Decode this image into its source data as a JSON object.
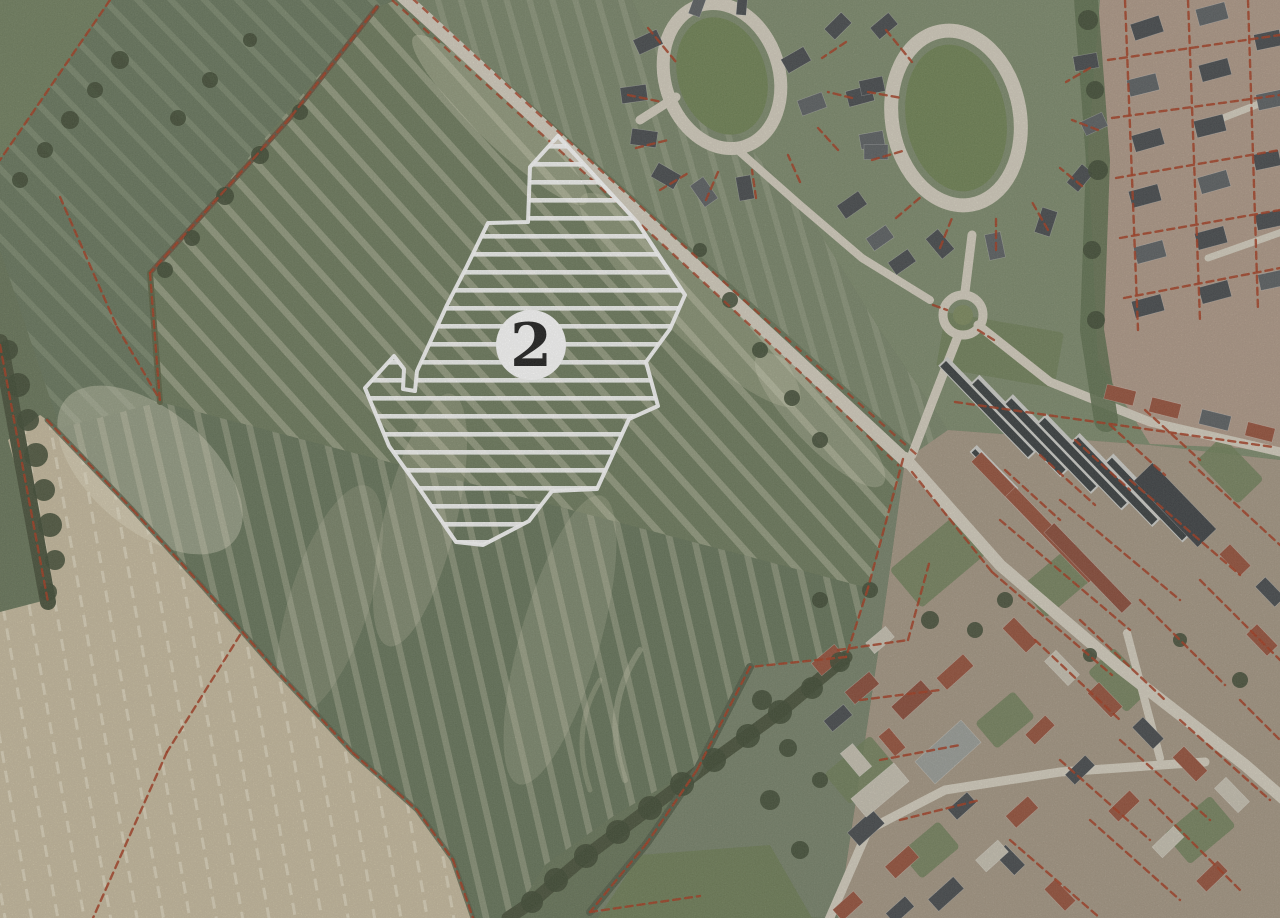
{
  "canvas": {
    "width": 1280,
    "height": 918
  },
  "map": {
    "type": "aerial-photograph-with-cadastral-overlay",
    "marker": {
      "label": "2",
      "bg": "#ffffff",
      "fg": "#1c1c1c"
    },
    "site": {
      "points": "558,136 637,222 685,295 670,329 646,362 658,406 629,419 597,489 552,491 529,521 483,545 456,542 421,491 389,446 365,388 394,356 404,369 403,389 415,391 417,371 447,305 466,268 488,223 528,222 530,167",
      "hatch_color": "#ffffff",
      "outline_color": "#ffffff"
    },
    "palette": {
      "cadastral": "#a63a1e",
      "road": "#d6d0c0",
      "hedge": "#48513a",
      "tree": "#3f4a33",
      "oval_green": "#6f8253",
      "garden_green": "#6e7f58",
      "roofs": {
        "dark": "#45494c",
        "mid": "#5b5f62",
        "red": "#96503a",
        "red2": "#8a4a38",
        "pale": "#c9c3b3",
        "dark2": "#3c4043",
        "gray2": "#9b9e99"
      }
    },
    "cadastral_segments": [
      [
        110,
        0,
        0,
        160
      ],
      [
        60,
        197,
        117,
        327
      ],
      [
        117,
        327,
        160,
        400
      ],
      [
        377,
        7,
        290,
        118
      ],
      [
        290,
        118,
        150,
        273
      ],
      [
        150,
        273,
        160,
        402
      ],
      [
        47,
        420,
        133,
        510
      ],
      [
        133,
        510,
        203,
        587
      ],
      [
        203,
        587,
        273,
        667
      ],
      [
        273,
        667,
        353,
        753
      ],
      [
        353,
        753,
        417,
        810
      ],
      [
        417,
        810,
        453,
        860
      ],
      [
        453,
        860,
        473,
        918
      ],
      [
        240,
        635,
        167,
        752
      ],
      [
        167,
        752,
        93,
        918
      ],
      [
        0,
        345,
        48,
        602
      ],
      [
        903,
        459,
        868,
        588
      ],
      [
        868,
        588,
        846,
        657
      ],
      [
        846,
        657,
        750,
        667
      ],
      [
        750,
        667,
        697,
        770
      ],
      [
        697,
        770,
        647,
        843
      ],
      [
        647,
        843,
        590,
        912
      ],
      [
        590,
        912,
        700,
        896
      ],
      [
        912,
        472,
        992,
        572
      ],
      [
        992,
        572,
        1112,
        675
      ],
      [
        955,
        402,
        1273,
        447
      ],
      [
        838,
        650,
        908,
        640
      ],
      [
        908,
        640,
        930,
        560
      ],
      [
        860,
        700,
        940,
        690
      ],
      [
        880,
        760,
        960,
        745
      ],
      [
        900,
        820,
        980,
        800
      ],
      [
        1005,
        470,
        1060,
        520
      ],
      [
        1040,
        455,
        1095,
        505
      ],
      [
        1075,
        440,
        1130,
        490
      ],
      [
        1110,
        425,
        1165,
        475
      ],
      [
        1145,
        410,
        1200,
        460
      ],
      [
        1000,
        520,
        1130,
        630
      ],
      [
        1060,
        500,
        1180,
        600
      ],
      [
        1130,
        480,
        1240,
        575
      ],
      [
        1190,
        462,
        1280,
        545
      ],
      [
        1035,
        640,
        1120,
        720
      ],
      [
        1080,
        620,
        1165,
        700
      ],
      [
        1140,
        600,
        1225,
        685
      ],
      [
        1200,
        580,
        1280,
        660
      ],
      [
        1060,
        760,
        1150,
        840
      ],
      [
        1120,
        740,
        1210,
        820
      ],
      [
        1180,
        720,
        1270,
        800
      ],
      [
        1240,
        700,
        1280,
        740
      ],
      [
        1010,
        840,
        1100,
        918
      ],
      [
        1090,
        820,
        1180,
        900
      ],
      [
        1150,
        800,
        1240,
        890
      ],
      [
        1125,
        0,
        1138,
        330
      ],
      [
        1188,
        0,
        1200,
        320
      ],
      [
        1248,
        0,
        1258,
        310
      ],
      [
        1108,
        60,
        1280,
        35
      ],
      [
        1112,
        118,
        1280,
        95
      ],
      [
        1116,
        178,
        1280,
        150
      ],
      [
        1120,
        238,
        1280,
        210
      ],
      [
        1124,
        298,
        1280,
        268
      ],
      [
        648,
        28,
        676,
        62
      ],
      [
        628,
        95,
        662,
        102
      ],
      [
        636,
        148,
        668,
        140
      ],
      [
        660,
        190,
        690,
        172
      ],
      [
        706,
        200,
        718,
        172
      ],
      [
        756,
        198,
        752,
        170
      ],
      [
        800,
        182,
        788,
        155
      ],
      [
        838,
        150,
        818,
        128
      ],
      [
        852,
        98,
        828,
        92
      ],
      [
        846,
        42,
        822,
        58
      ],
      [
        886,
        30,
        912,
        62
      ],
      [
        868,
        92,
        902,
        98
      ],
      [
        872,
        160,
        906,
        150
      ],
      [
        896,
        218,
        922,
        196
      ],
      [
        940,
        248,
        952,
        218
      ],
      [
        996,
        250,
        996,
        218
      ],
      [
        1048,
        230,
        1032,
        202
      ],
      [
        1082,
        186,
        1060,
        168
      ],
      [
        1098,
        130,
        1072,
        120
      ],
      [
        1090,
        68,
        1066,
        82
      ],
      [
        933,
        305,
        947,
        310
      ],
      [
        978,
        330,
        994,
        340
      ]
    ],
    "houses": [
      [
        648,
        42,
        26,
        16,
        -25,
        "dark"
      ],
      [
        634,
        94,
        26,
        16,
        -8,
        "dark"
      ],
      [
        644,
        138,
        26,
        16,
        8,
        "dark"
      ],
      [
        666,
        176,
        26,
        16,
        30,
        "dark"
      ],
      [
        704,
        192,
        26,
        16,
        55,
        "mid"
      ],
      [
        745,
        188,
        24,
        15,
        80,
        "dark"
      ],
      [
        698,
        4,
        24,
        12,
        -70,
        "mid"
      ],
      [
        742,
        4,
        22,
        10,
        -85,
        "dark"
      ],
      [
        796,
        60,
        26,
        16,
        -30,
        "dark"
      ],
      [
        812,
        104,
        26,
        16,
        -20,
        "mid"
      ],
      [
        838,
        26,
        24,
        15,
        -45,
        "dark"
      ],
      [
        860,
        96,
        26,
        16,
        -15,
        "dark"
      ],
      [
        872,
        140,
        24,
        15,
        -10,
        "mid"
      ],
      [
        884,
        26,
        24,
        15,
        -40,
        "dark"
      ],
      [
        872,
        86,
        24,
        15,
        -12,
        "dark"
      ],
      [
        876,
        152,
        24,
        15,
        0,
        "mid"
      ],
      [
        852,
        205,
        26,
        16,
        -35,
        "dark"
      ],
      [
        880,
        238,
        24,
        15,
        -35,
        "mid"
      ],
      [
        902,
        262,
        24,
        15,
        -35,
        "dark"
      ],
      [
        940,
        244,
        26,
        16,
        50,
        "dark"
      ],
      [
        995,
        246,
        26,
        16,
        78,
        "mid"
      ],
      [
        1046,
        222,
        26,
        16,
        -72,
        "dark"
      ],
      [
        1080,
        178,
        24,
        15,
        -50,
        "dark"
      ],
      [
        1094,
        124,
        24,
        15,
        -25,
        "mid"
      ],
      [
        1086,
        62,
        24,
        15,
        -10,
        "dark"
      ],
      [
        1147,
        28,
        30,
        17,
        -18,
        "dark"
      ],
      [
        1143,
        85,
        30,
        17,
        -14,
        "mid"
      ],
      [
        1148,
        140,
        30,
        17,
        -16,
        "dark"
      ],
      [
        1145,
        196,
        30,
        17,
        -15,
        "dark"
      ],
      [
        1150,
        252,
        30,
        17,
        -15,
        "mid"
      ],
      [
        1148,
        306,
        30,
        17,
        -15,
        "dark"
      ],
      [
        1212,
        14,
        30,
        17,
        -15,
        "mid"
      ],
      [
        1215,
        70,
        30,
        17,
        -15,
        "dark"
      ],
      [
        1210,
        126,
        30,
        17,
        -14,
        "dark"
      ],
      [
        1214,
        182,
        30,
        17,
        -16,
        "mid"
      ],
      [
        1211,
        238,
        30,
        17,
        -15,
        "dark"
      ],
      [
        1215,
        292,
        30,
        17,
        -15,
        "dark"
      ],
      [
        1268,
        40,
        26,
        16,
        -12,
        "dark"
      ],
      [
        1270,
        100,
        26,
        16,
        -12,
        "mid"
      ],
      [
        1267,
        160,
        26,
        16,
        -12,
        "dark"
      ],
      [
        1269,
        220,
        26,
        16,
        -12,
        "dark"
      ],
      [
        1272,
        280,
        26,
        16,
        -12,
        "mid"
      ],
      [
        1120,
        395,
        30,
        15,
        14,
        "red"
      ],
      [
        1165,
        408,
        30,
        15,
        14,
        "red"
      ],
      [
        1215,
        420,
        30,
        15,
        14,
        "mid"
      ],
      [
        1260,
        432,
        28,
        14,
        14,
        "red"
      ],
      [
        1018,
        500,
        120,
        14,
        46,
        "red"
      ],
      [
        1052,
        535,
        120,
        14,
        46,
        "red"
      ],
      [
        1088,
        568,
        112,
        14,
        46,
        "red2"
      ],
      [
        1175,
        505,
        92,
        26,
        46,
        "dark2"
      ],
      [
        1020,
        635,
        34,
        16,
        46,
        "red"
      ],
      [
        1062,
        668,
        34,
        16,
        46,
        "pale"
      ],
      [
        1105,
        700,
        34,
        16,
        46,
        "red"
      ],
      [
        1148,
        733,
        30,
        15,
        46,
        "dark"
      ],
      [
        1190,
        764,
        34,
        16,
        46,
        "red"
      ],
      [
        1232,
        795,
        34,
        16,
        46,
        "pale"
      ],
      [
        1040,
        730,
        28,
        14,
        -44,
        "red"
      ],
      [
        1080,
        770,
        28,
        14,
        -44,
        "dark"
      ],
      [
        1124,
        806,
        30,
        15,
        -44,
        "red"
      ],
      [
        1168,
        842,
        30,
        15,
        -44,
        "pale"
      ],
      [
        1212,
        876,
        30,
        15,
        -44,
        "red"
      ],
      [
        1010,
        860,
        28,
        15,
        46,
        "dark"
      ],
      [
        1060,
        895,
        30,
        15,
        46,
        "red"
      ],
      [
        828,
        660,
        30,
        16,
        -40,
        "red"
      ],
      [
        862,
        688,
        32,
        16,
        -40,
        "red2"
      ],
      [
        838,
        718,
        26,
        14,
        -40,
        "dark"
      ],
      [
        880,
        640,
        26,
        14,
        -40,
        "pale"
      ],
      [
        856,
        760,
        30,
        16,
        50,
        "pale"
      ],
      [
        892,
        742,
        26,
        14,
        50,
        "red"
      ],
      [
        866,
        828,
        34,
        18,
        -42,
        "dark"
      ],
      [
        902,
        862,
        32,
        16,
        -42,
        "red"
      ],
      [
        946,
        894,
        34,
        16,
        -42,
        "dark"
      ],
      [
        992,
        856,
        30,
        16,
        -42,
        "pale"
      ],
      [
        1022,
        812,
        30,
        16,
        -42,
        "red"
      ],
      [
        962,
        806,
        26,
        14,
        -42,
        "dark"
      ],
      [
        948,
        752,
        62,
        30,
        -42,
        "gray2"
      ],
      [
        912,
        700,
        40,
        18,
        -42,
        "red2"
      ],
      [
        955,
        672,
        36,
        16,
        -42,
        "red"
      ],
      [
        848,
        906,
        28,
        15,
        -42,
        "red"
      ],
      [
        900,
        910,
        26,
        14,
        -42,
        "dark"
      ],
      [
        1235,
        560,
        30,
        15,
        46,
        "red"
      ],
      [
        1270,
        592,
        28,
        14,
        46,
        "dark"
      ],
      [
        1262,
        640,
        30,
        15,
        46,
        "red"
      ],
      [
        880,
        790,
        56,
        24,
        -40,
        "pale"
      ]
    ],
    "barns": [
      [
        988,
        408,
        130,
        13
      ],
      [
        1020,
        426,
        130,
        13
      ],
      [
        1052,
        444,
        126,
        13
      ],
      [
        1084,
        462,
        122,
        13
      ],
      [
        1116,
        480,
        118,
        13
      ],
      [
        1148,
        498,
        112,
        12
      ],
      [
        994,
        470,
        60,
        10
      ]
    ],
    "gardens": [
      [
        940,
        560,
        90,
        50,
        -40
      ],
      [
        1060,
        580,
        70,
        40,
        -40
      ],
      [
        1230,
        470,
        60,
        36,
        46
      ],
      [
        860,
        770,
        60,
        40,
        -40
      ],
      [
        1120,
        680,
        56,
        36,
        46
      ],
      [
        1005,
        720,
        50,
        34,
        -40
      ],
      [
        1200,
        830,
        60,
        40,
        -40
      ],
      [
        930,
        850,
        50,
        34,
        -40
      ],
      [
        1000,
        350,
        120,
        56,
        10
      ]
    ],
    "trees": [
      [
        8,
        350,
        10
      ],
      [
        18,
        385,
        12
      ],
      [
        28,
        420,
        11
      ],
      [
        36,
        455,
        12
      ],
      [
        44,
        490,
        11
      ],
      [
        50,
        525,
        12
      ],
      [
        55,
        560,
        10
      ],
      [
        48,
        592,
        9
      ],
      [
        300,
        112,
        8
      ],
      [
        260,
        155,
        9
      ],
      [
        225,
        196,
        9
      ],
      [
        192,
        238,
        8
      ],
      [
        165,
        270,
        8
      ],
      [
        840,
        662,
        10
      ],
      [
        812,
        688,
        11
      ],
      [
        780,
        712,
        12
      ],
      [
        748,
        736,
        12
      ],
      [
        714,
        760,
        12
      ],
      [
        682,
        784,
        12
      ],
      [
        650,
        808,
        12
      ],
      [
        618,
        832,
        12
      ],
      [
        586,
        856,
        12
      ],
      [
        556,
        880,
        12
      ],
      [
        532,
        902,
        11
      ],
      [
        762,
        700,
        10
      ],
      [
        788,
        748,
        9
      ],
      [
        770,
        800,
        10
      ],
      [
        800,
        850,
        9
      ],
      [
        820,
        780,
        8
      ],
      [
        930,
        620,
        9
      ],
      [
        1005,
        600,
        8
      ],
      [
        975,
        630,
        8
      ],
      [
        1090,
        655,
        7
      ],
      [
        1240,
        680,
        8
      ],
      [
        1180,
        640,
        7
      ],
      [
        870,
        590,
        8
      ],
      [
        820,
        600,
        8
      ],
      [
        700,
        250,
        7
      ],
      [
        730,
        300,
        8
      ],
      [
        760,
        350,
        8
      ],
      [
        792,
        398,
        8
      ],
      [
        820,
        440,
        8
      ],
      [
        120,
        60,
        9
      ],
      [
        95,
        90,
        8
      ],
      [
        70,
        120,
        9
      ],
      [
        45,
        150,
        8
      ],
      [
        20,
        180,
        8
      ],
      [
        250,
        40,
        7
      ],
      [
        210,
        80,
        8
      ],
      [
        178,
        118,
        8
      ],
      [
        1088,
        20,
        10
      ],
      [
        1095,
        90,
        9
      ],
      [
        1098,
        170,
        10
      ],
      [
        1092,
        250,
        9
      ],
      [
        1096,
        320,
        9
      ]
    ]
  }
}
